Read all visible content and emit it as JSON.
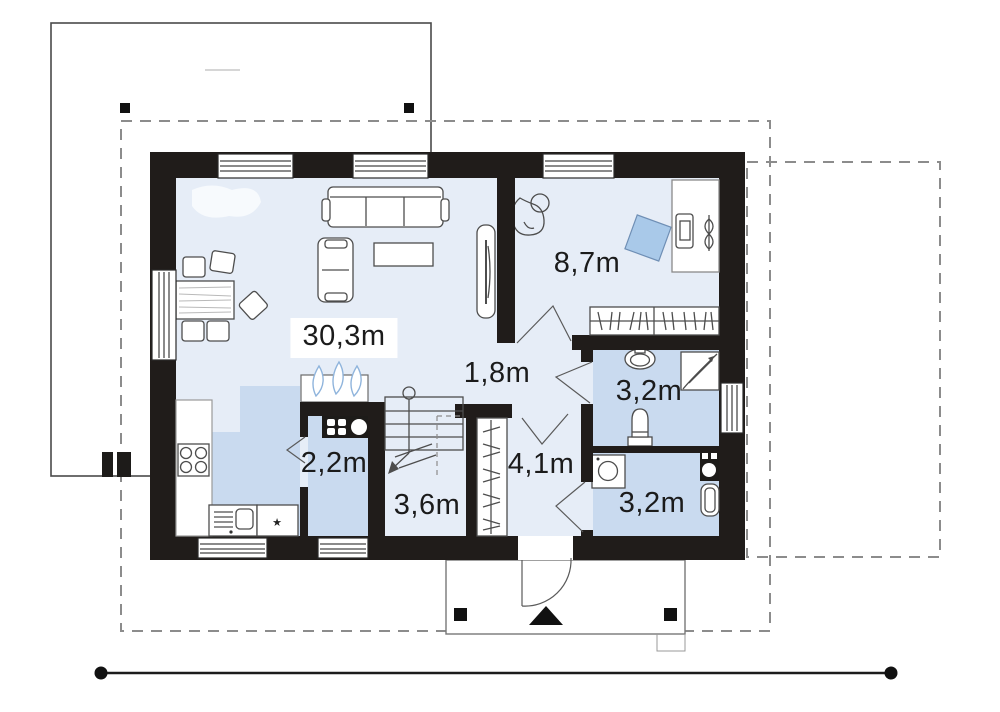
{
  "plan": {
    "type": "floor-plan",
    "floor": "ground floor",
    "units": "m"
  },
  "rooms": {
    "living": {
      "name": "living-room-kitchen",
      "area": "30,3m"
    },
    "bedroom": {
      "name": "bedroom-office",
      "area": "8,7m"
    },
    "hall": {
      "name": "inner-hall",
      "area": "1,8m"
    },
    "bathroom_top": {
      "name": "bathroom",
      "area": "3,2m"
    },
    "kitchen_pantry": {
      "name": "pantry",
      "area": "2,2m"
    },
    "staircase": {
      "name": "staircase",
      "area": "3,6m"
    },
    "entrance_hall": {
      "name": "entrance-hall",
      "area": "4,1m"
    },
    "bathroom_bottom": {
      "name": "utility-bathroom",
      "area": "3,2m"
    }
  },
  "icons": {
    "star": "★"
  },
  "colors": {
    "wall": "#201c1a",
    "floor_light": "#e6edf7",
    "floor_medium": "#c9daef",
    "accent_blue": "#a9c9e9",
    "dash": "#8c8c8c",
    "line": "#4d4d4d"
  }
}
